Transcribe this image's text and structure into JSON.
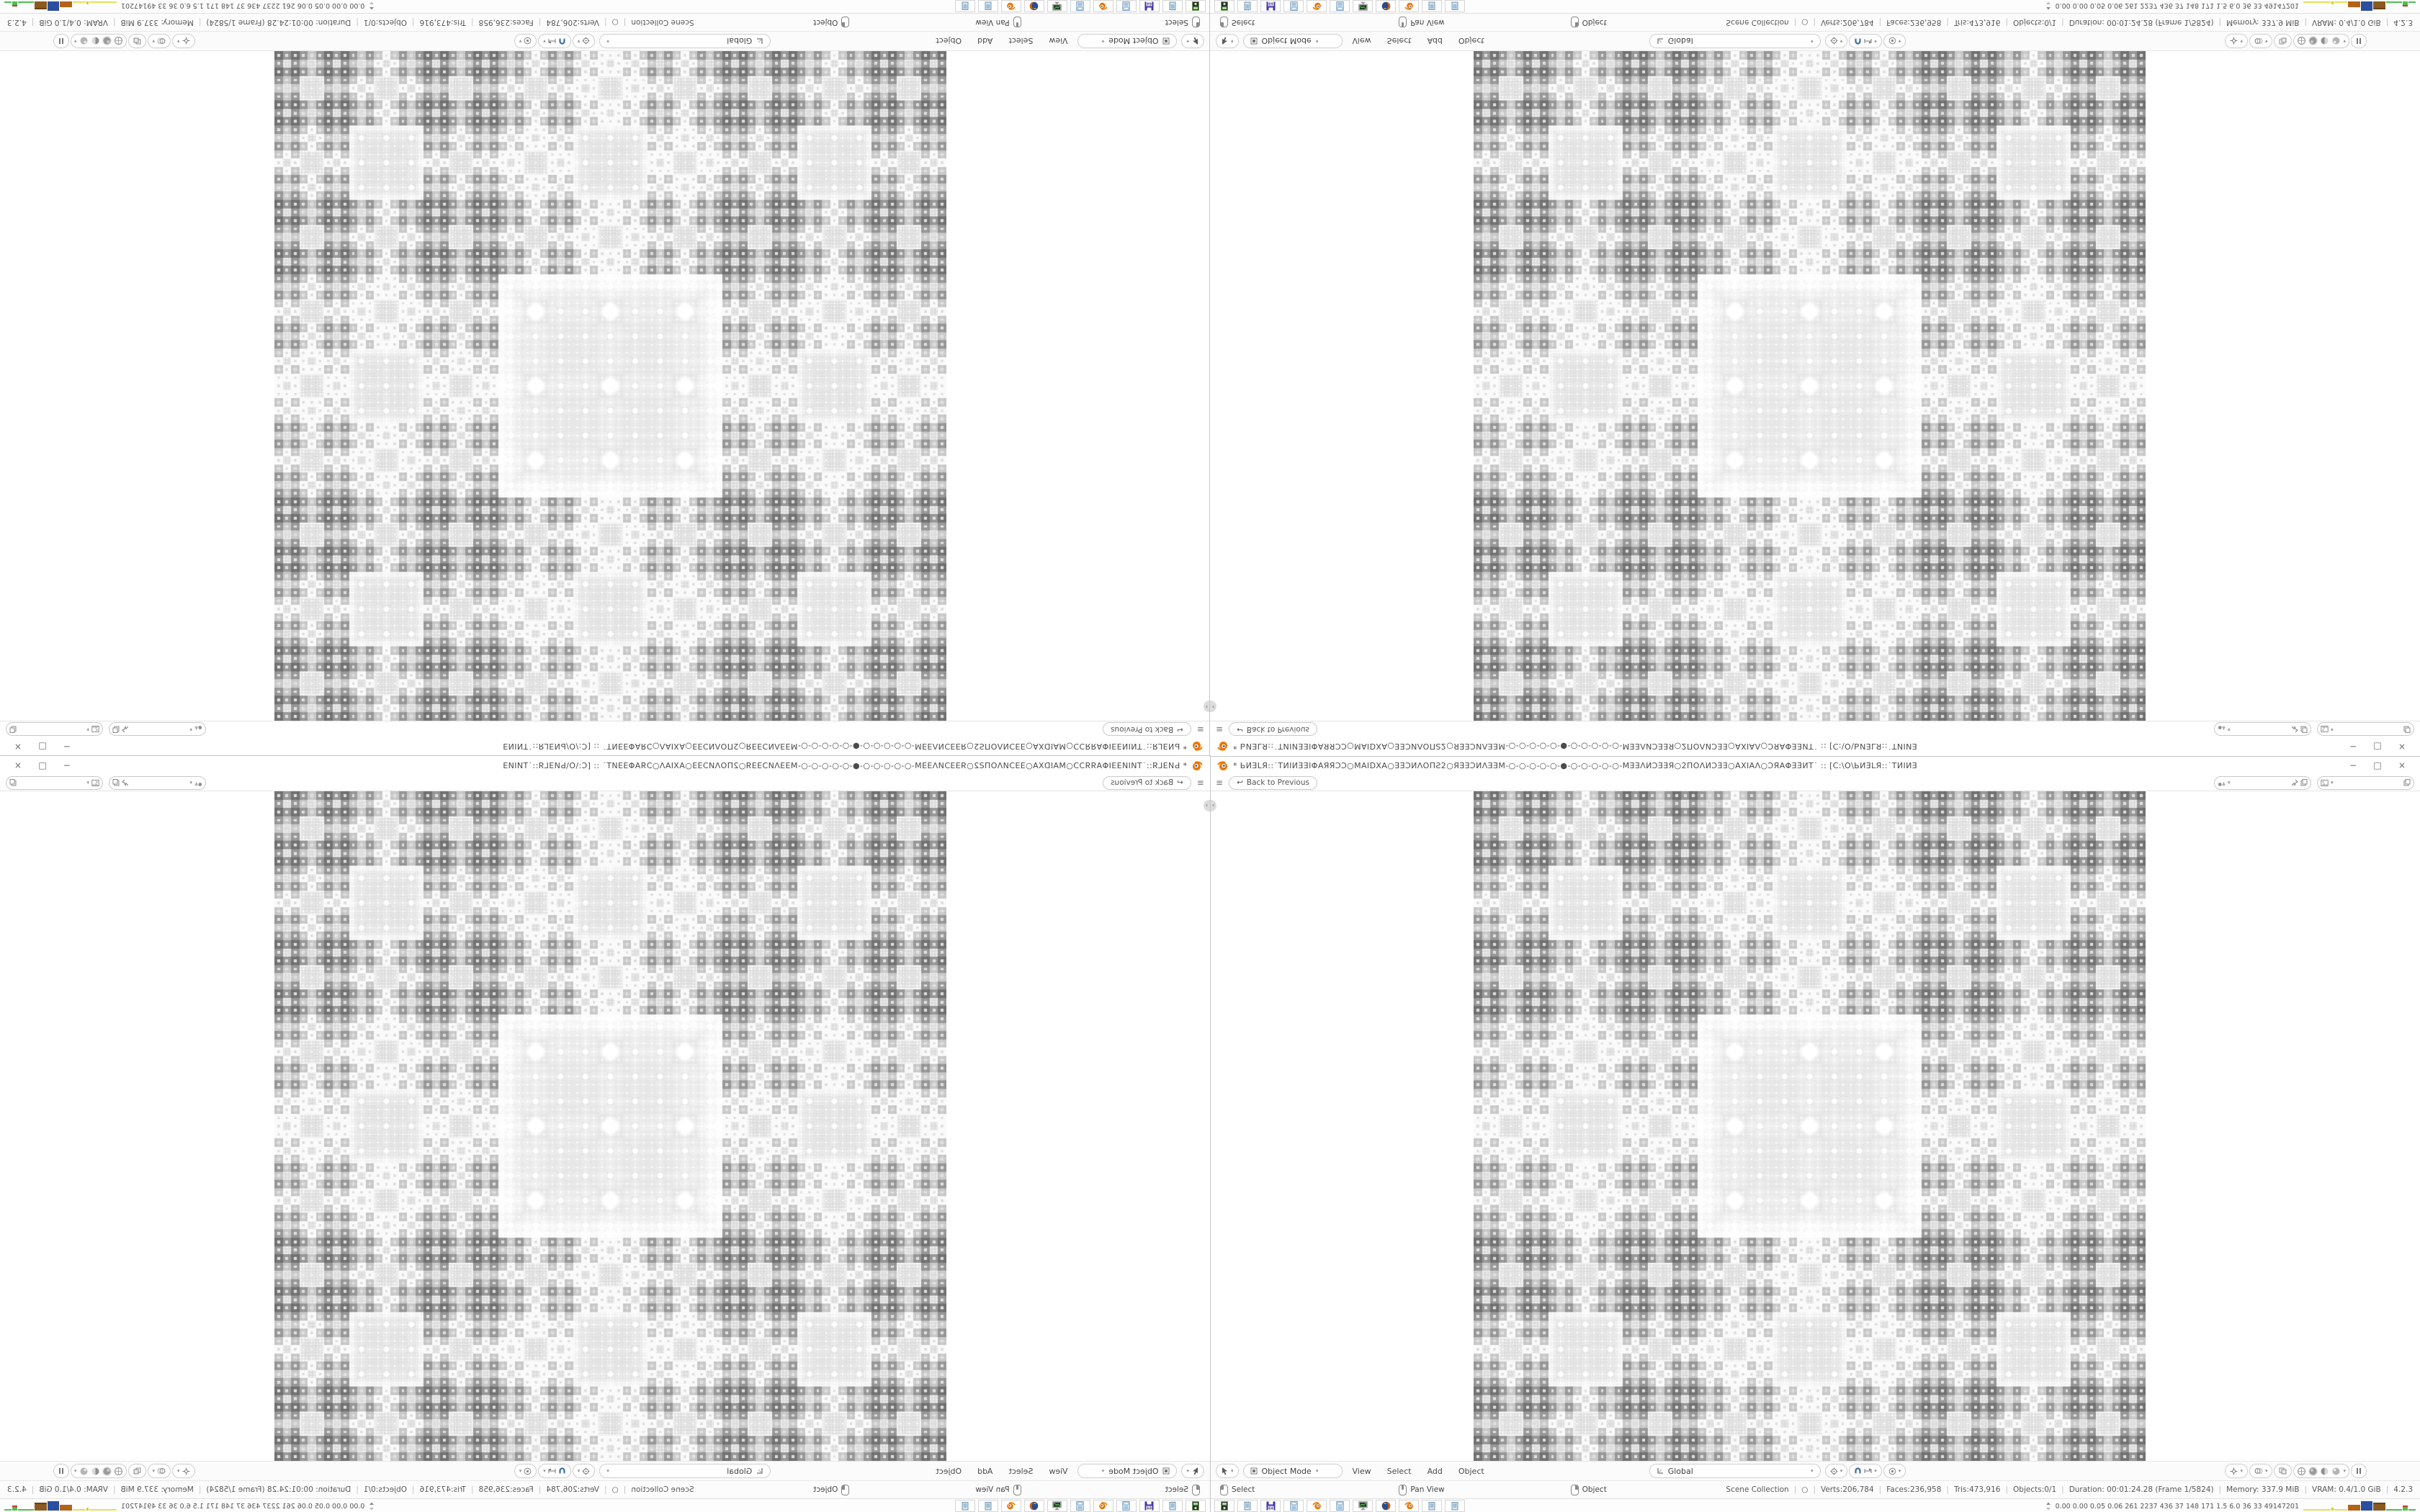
{
  "window": {
    "title": "* ЬИƎLЯ::˙TИIИƎƎIΦAЯЯƆƆ○MAIDXA○ƎƎƆИΛΟΠƧ2○ЯƎƎƆИΛƎƎM-○-○-○-○-○-●-○-○-○-○-○-MƎƎΛИƆƎƎЯ○2ΠΟΛИƆƎƎ○AXIAΛ○ƆЯAΦƎƎИΤ˙ :: [C:\\O\\ЬИƎLЯ::˙TИIИƎ",
    "controls": {
      "minimize": "−",
      "restore": "□",
      "close": "×"
    }
  },
  "topbar": {
    "menu_glyph": "≡",
    "back_icon": "↩",
    "back_label": "Back to Previous",
    "scene_value": "",
    "viewlayer_value": ""
  },
  "viewport": {
    "header": {
      "mode_label": "Object Mode",
      "menus": [
        "View",
        "Select",
        "Add",
        "Object"
      ],
      "orientation_label": "Global"
    }
  },
  "statusbar": {
    "hints": [
      "Select",
      "Pan View",
      "Object"
    ],
    "segments": [
      "Scene Collection",
      "○",
      "Verts:206,784",
      "Faces:236,958",
      "Tris:473,916",
      "Objects:0/1",
      "Duration: 00:01:24.28 (Frame 1/5824)",
      "Memory: 337.9 MiB",
      "VRAM: 0.4/1.0 GiB",
      "4.2.3"
    ]
  },
  "taskbar": {
    "apps": [
      "capture-device",
      "notepad",
      "setup-x64",
      "calculator",
      "blender",
      "calculator",
      "system-monitor",
      "firefox",
      "blender",
      "notepad",
      "notepad"
    ],
    "stats_text": "0.00 0.00 0.05 0.06  261 2237 436  37  148  171  1.5  6.0  36  33  49147201",
    "graph_colors": {
      "yellow": "#e6e05a",
      "orange": "#b46316",
      "blue": "#2a4f9e",
      "brown": "#8a5a1e",
      "green": "#4fbf4f",
      "red": "#c0392b"
    }
  },
  "fractal": {
    "pattern": "sierpinski-carpet-plaid",
    "base_gray": "#707070",
    "hole_white": "#f2f2f2"
  }
}
